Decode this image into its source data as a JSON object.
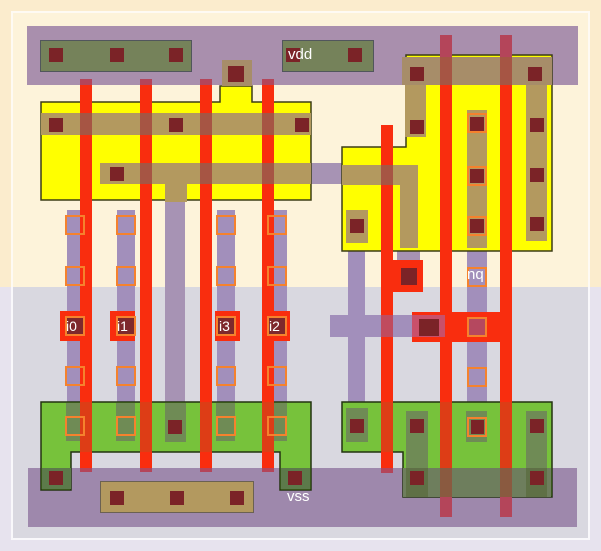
{
  "pins": {
    "vdd": "vdd",
    "vss": "vss",
    "nq": "nq",
    "i0": "i0",
    "i1": "i1",
    "i2": "i2",
    "i3": "i3"
  },
  "colors": {
    "nwell": "#fbeccd",
    "nwell_inner": "#fdf3da",
    "substrate": "#e7e3ee",
    "substrate_inner": "#d9d8e0",
    "rail_vdd": "#a98fad",
    "rail_vss": "#9e88ac",
    "metal1": "#a28fbb",
    "metal1_cream": "#a793b4",
    "pdiff": "#ffff00",
    "ndiff": "#77c23b",
    "tap": "#75825a",
    "li": "#b3995f",
    "li_rail": "#a78d69",
    "poly": "#f92d0e",
    "poly_green": "#dd3d16",
    "poly_rail": "#b4455a",
    "poly_li": "#a65544",
    "contact": "#7b2327",
    "via": "#f5822d"
  }
}
